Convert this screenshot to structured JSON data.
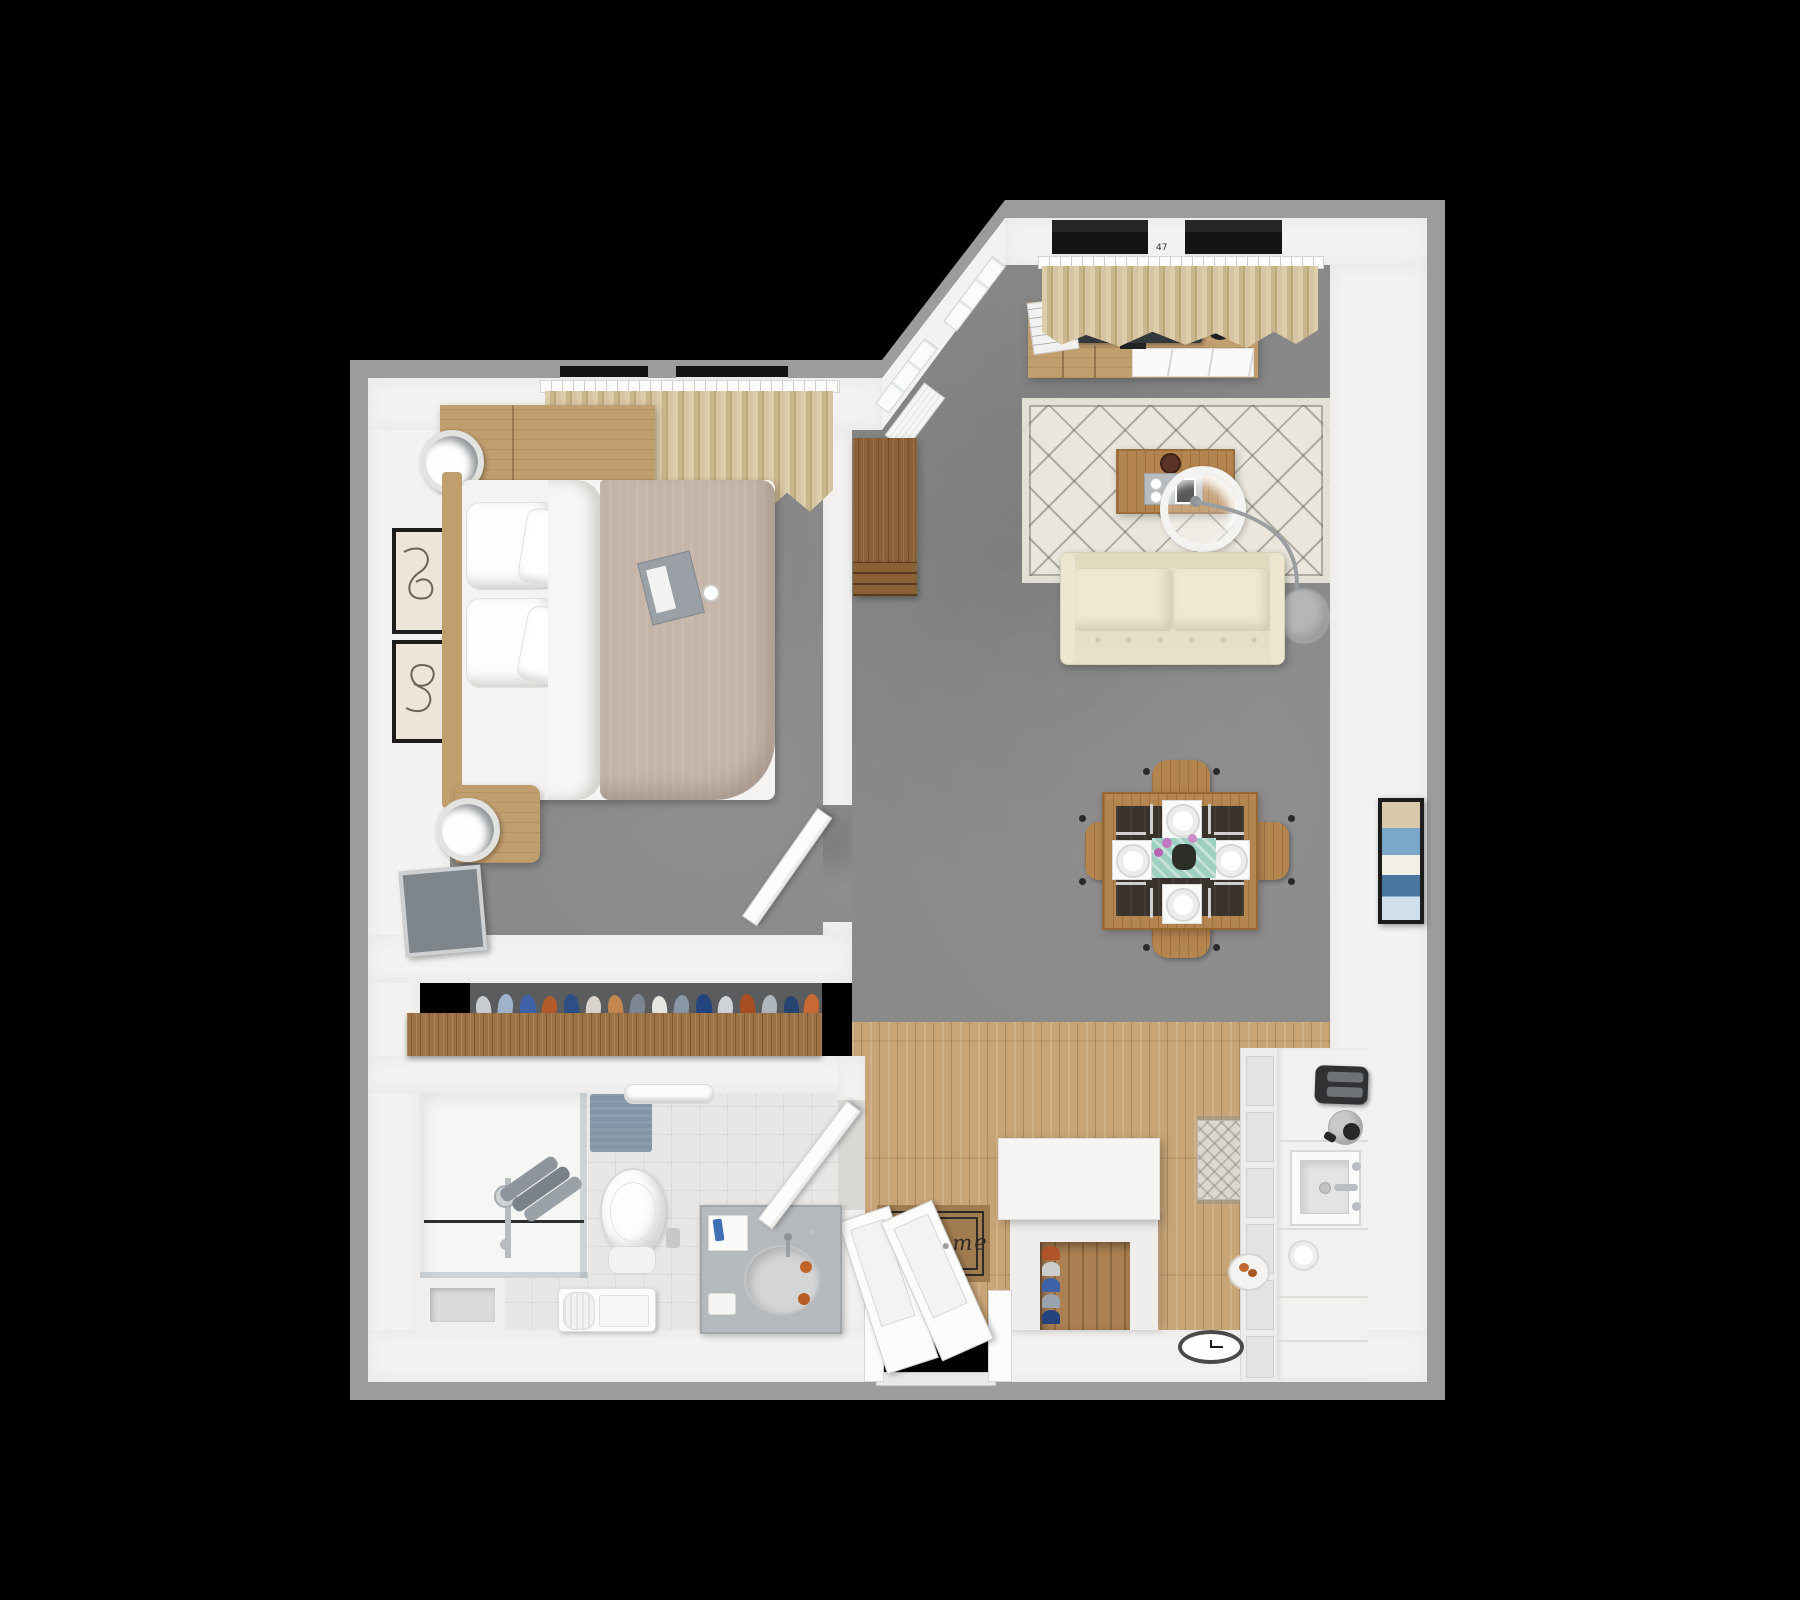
{
  "scene": {
    "title": "3D apartment floor plan - top-down dollhouse render",
    "view": "top-down 3D render of a one-bedroom apartment on black background",
    "background": "#000000"
  },
  "labels": {
    "welcome_mat_text": "Welcome",
    "curtain_rail_mark": "47"
  },
  "palette": {
    "outer_wall_edge": "#9c9c9c",
    "wall_face": "#f3f2f0",
    "carpet": "#8a8a8a",
    "wood_floor": "#c8a577",
    "closet_wood": "#9c7344",
    "bathroom_tile": "#e8e7e5",
    "rug": "#eae6dc",
    "sofa": "#e9e2cb",
    "duvet": "#c5b4a8",
    "curtain": "#d3c2a0",
    "furniture_wood": "#c19e6e",
    "dining_wood": "#b5854f",
    "accent_teal": "#9fcfc0",
    "accent_rust": "#b35a2b",
    "accent_blue": "#3f62a8",
    "towel_blue_gray": "#8195a6"
  },
  "rooms": [
    {
      "name": "bedroom",
      "floor": "gray carpet",
      "furniture": [
        "double bed with taupe duvet",
        "white pillow stacks",
        "headboard dresser with round silver lamp",
        "nightstand with round silver lamp",
        "two framed artworks",
        "flat tv leaning on south wall",
        "tan curtains over two windows",
        "open white door"
      ]
    },
    {
      "name": "closet",
      "floor": "dark recess",
      "furniture": [
        "full-width wood wardrobe shelf with hanging clothes in blue, navy, rust, gray and white"
      ]
    },
    {
      "name": "bathroom",
      "floor": "light tile",
      "furniture": [
        "glass walk-in shower with chrome fixtures",
        "gray towels on glass",
        "blue bath mat",
        "towel rail with white towel",
        "toilet with paper holder",
        "stone vanity with oval sink, faucet, toothbrush cup, orange bottles",
        "white bench with rolled towel",
        "open white door"
      ]
    },
    {
      "name": "hallway",
      "floor": "carpet transitioning to wood planks",
      "furniture": [
        "tall wooden bookcase with drawers"
      ]
    },
    {
      "name": "living-room",
      "floor": "gray carpet",
      "furniture": [
        "wood tv sideboard with flat tv, magazines and black potted plant",
        "tan curtains over two windows",
        "diagonal wall with white framed windows",
        "berber patterned area rug",
        "wood coffee table with gray tray, two cups, tablet and brown bowl",
        "white arc floor lamp with round shade and gray base",
        "cream two-seat sofa"
      ]
    },
    {
      "name": "dining-area",
      "floor": "gray carpet",
      "furniture": [
        "square wood dining table",
        "dark runner",
        "teal center mat with vase of pink flowers",
        "four white place settings with cutlery",
        "four curved wooden chairs",
        "framed abstract art on east wall"
      ]
    },
    {
      "name": "kitchen",
      "floor": "light wood planks",
      "furniture": [
        "white cabinet run with paneled fronts",
        "black toaster",
        "silver kettle",
        "square white sink with chrome faucet",
        "white plate",
        "patterned kitchen mat",
        "pet bowl with food"
      ]
    },
    {
      "name": "entry",
      "floor": "light wood planks",
      "furniture": [
        "double white entry doors opening inward",
        "brown welcome mat",
        "white shoe-cabinet island with wood niche and stacked shoes",
        "wall clock near door"
      ]
    }
  ]
}
